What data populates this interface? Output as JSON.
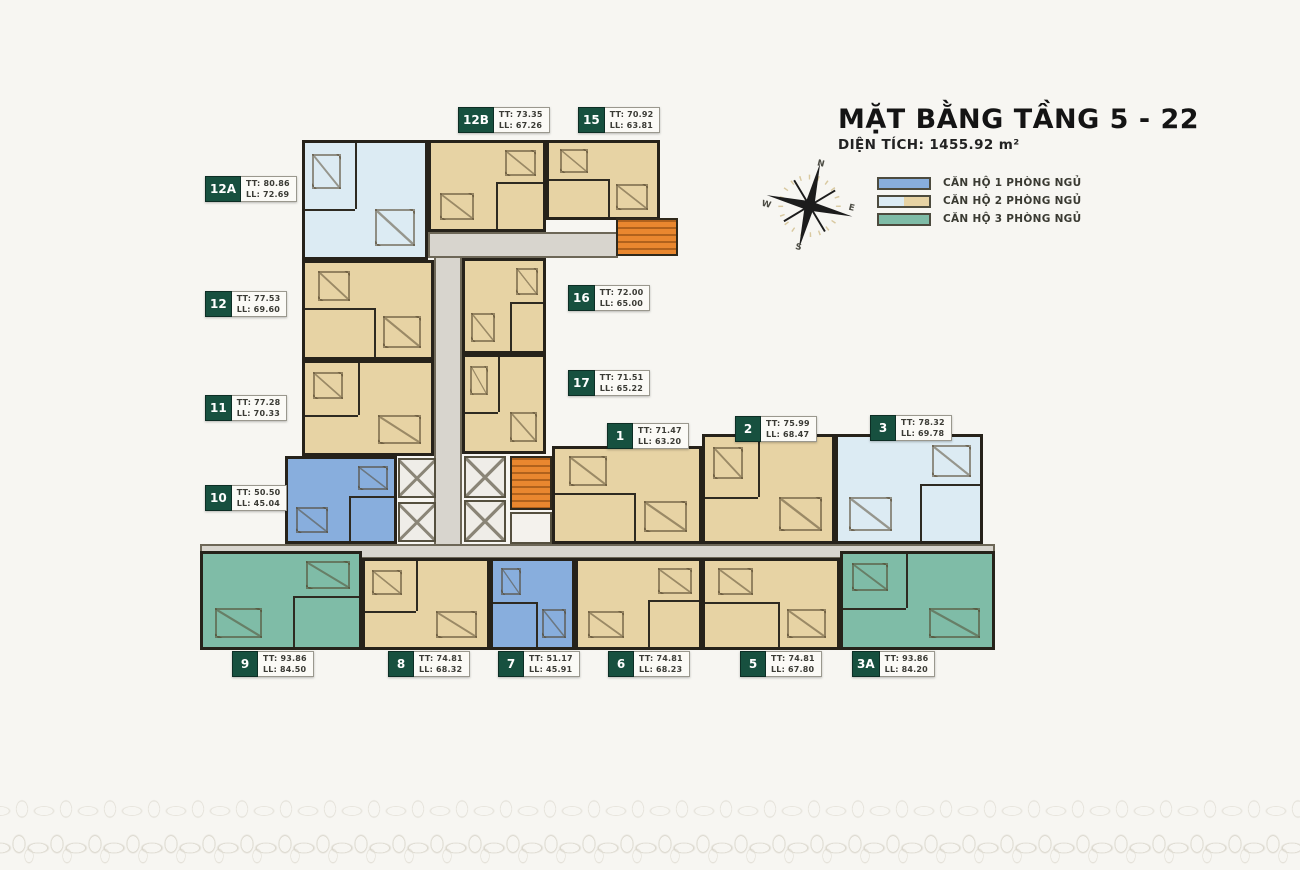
{
  "title": {
    "main": "MẶT BẰNG TẦNG 5 - 22",
    "area_text": "DIỆN TÍCH: 1455.92 m²"
  },
  "compass": {
    "n": "N",
    "e": "E",
    "s": "S",
    "w": "W"
  },
  "legend": {
    "items": [
      {
        "label": "CĂN HỘ 1 PHÒNG NGỦ"
      },
      {
        "label": "CĂN HỘ 2 PHÒNG NGỦ"
      },
      {
        "label": "CĂN HỘ 3 PHÒNG NGỦ"
      }
    ]
  },
  "colors": {
    "one_bedroom": "#88aedd",
    "two_bedroom_tan": "#e7d3a4",
    "two_bedroom_blue": "#dcebf3",
    "three_bedroom": "#7fbca7",
    "stairs_orange": "#e9872f",
    "corridor_gray": "#d8d5ce",
    "label_badge_green": "#17503f"
  },
  "units": [
    {
      "id": "12A",
      "tt": "TT: 80.86",
      "ll": "LL: 72.69"
    },
    {
      "id": "12B",
      "tt": "TT: 73.35",
      "ll": "LL: 67.26"
    },
    {
      "id": "15",
      "tt": "TT: 70.92",
      "ll": "LL: 63.81"
    },
    {
      "id": "12",
      "tt": "TT: 77.53",
      "ll": "LL: 69.60"
    },
    {
      "id": "11",
      "tt": "TT: 77.28",
      "ll": "LL: 70.33"
    },
    {
      "id": "10",
      "tt": "TT: 50.50",
      "ll": "LL: 45.04"
    },
    {
      "id": "16",
      "tt": "TT: 72.00",
      "ll": "LL: 65.00"
    },
    {
      "id": "17",
      "tt": "TT: 71.51",
      "ll": "LL: 65.22"
    },
    {
      "id": "1",
      "tt": "TT: 71.47",
      "ll": "LL: 63.20"
    },
    {
      "id": "2",
      "tt": "TT: 75.99",
      "ll": "LL: 68.47"
    },
    {
      "id": "3",
      "tt": "TT: 78.32",
      "ll": "LL: 69.78"
    },
    {
      "id": "9",
      "tt": "TT: 93.86",
      "ll": "LL: 84.50"
    },
    {
      "id": "8",
      "tt": "TT: 74.81",
      "ll": "LL: 68.32"
    },
    {
      "id": "7",
      "tt": "TT: 51.17",
      "ll": "LL: 45.91"
    },
    {
      "id": "6",
      "tt": "TT: 74.81",
      "ll": "LL: 68.23"
    },
    {
      "id": "5",
      "tt": "TT: 74.81",
      "ll": "LL: 67.80"
    },
    {
      "id": "3A",
      "tt": "TT: 93.86",
      "ll": "LL: 84.20"
    }
  ]
}
